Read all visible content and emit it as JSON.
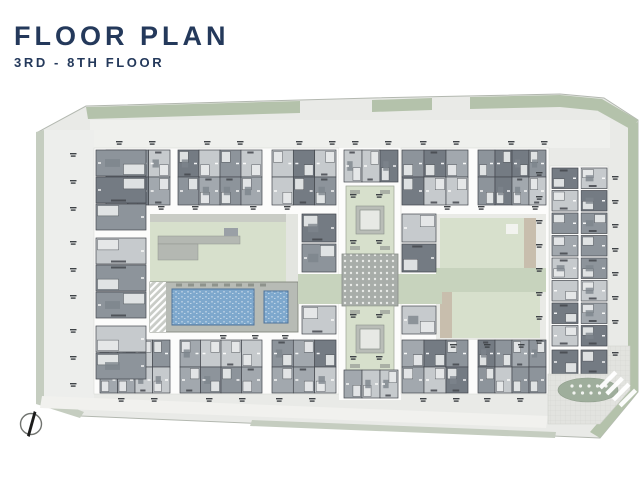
{
  "header": {
    "title": "FLOOR PLAN",
    "subtitle": "3RD - 8TH FLOOR"
  },
  "compass": {
    "icon": "north-arrow-icon"
  },
  "colors": {
    "title": "#24395b",
    "site": "#e9eae7",
    "site_edge": "#b3b8b0",
    "inner_apron": "#eff0ed",
    "slab": "#fcfcfb",
    "green_band": "#b4c2ab",
    "green_edge": "#c5cdc0",
    "lawn": "#d7e0cc",
    "sage": "#c7d3bd",
    "deck": "#b7bbb5",
    "pool": "#7ea8cd",
    "pool_light": "#b3cbe2",
    "wall": "#44484e",
    "unit_light": "#c6cacd",
    "unit_mid": "#a2a8ae",
    "unit_mid2": "#8d949b",
    "unit_dark": "#747b83",
    "tan": "#c8bead",
    "plaza_dot_bg": "#a8ada9",
    "paving": "#e2e3df",
    "oval": "#9fae9c",
    "tick": "#3e4246",
    "road": "#f1f1ee",
    "compass_stroke": "#70736f"
  }
}
